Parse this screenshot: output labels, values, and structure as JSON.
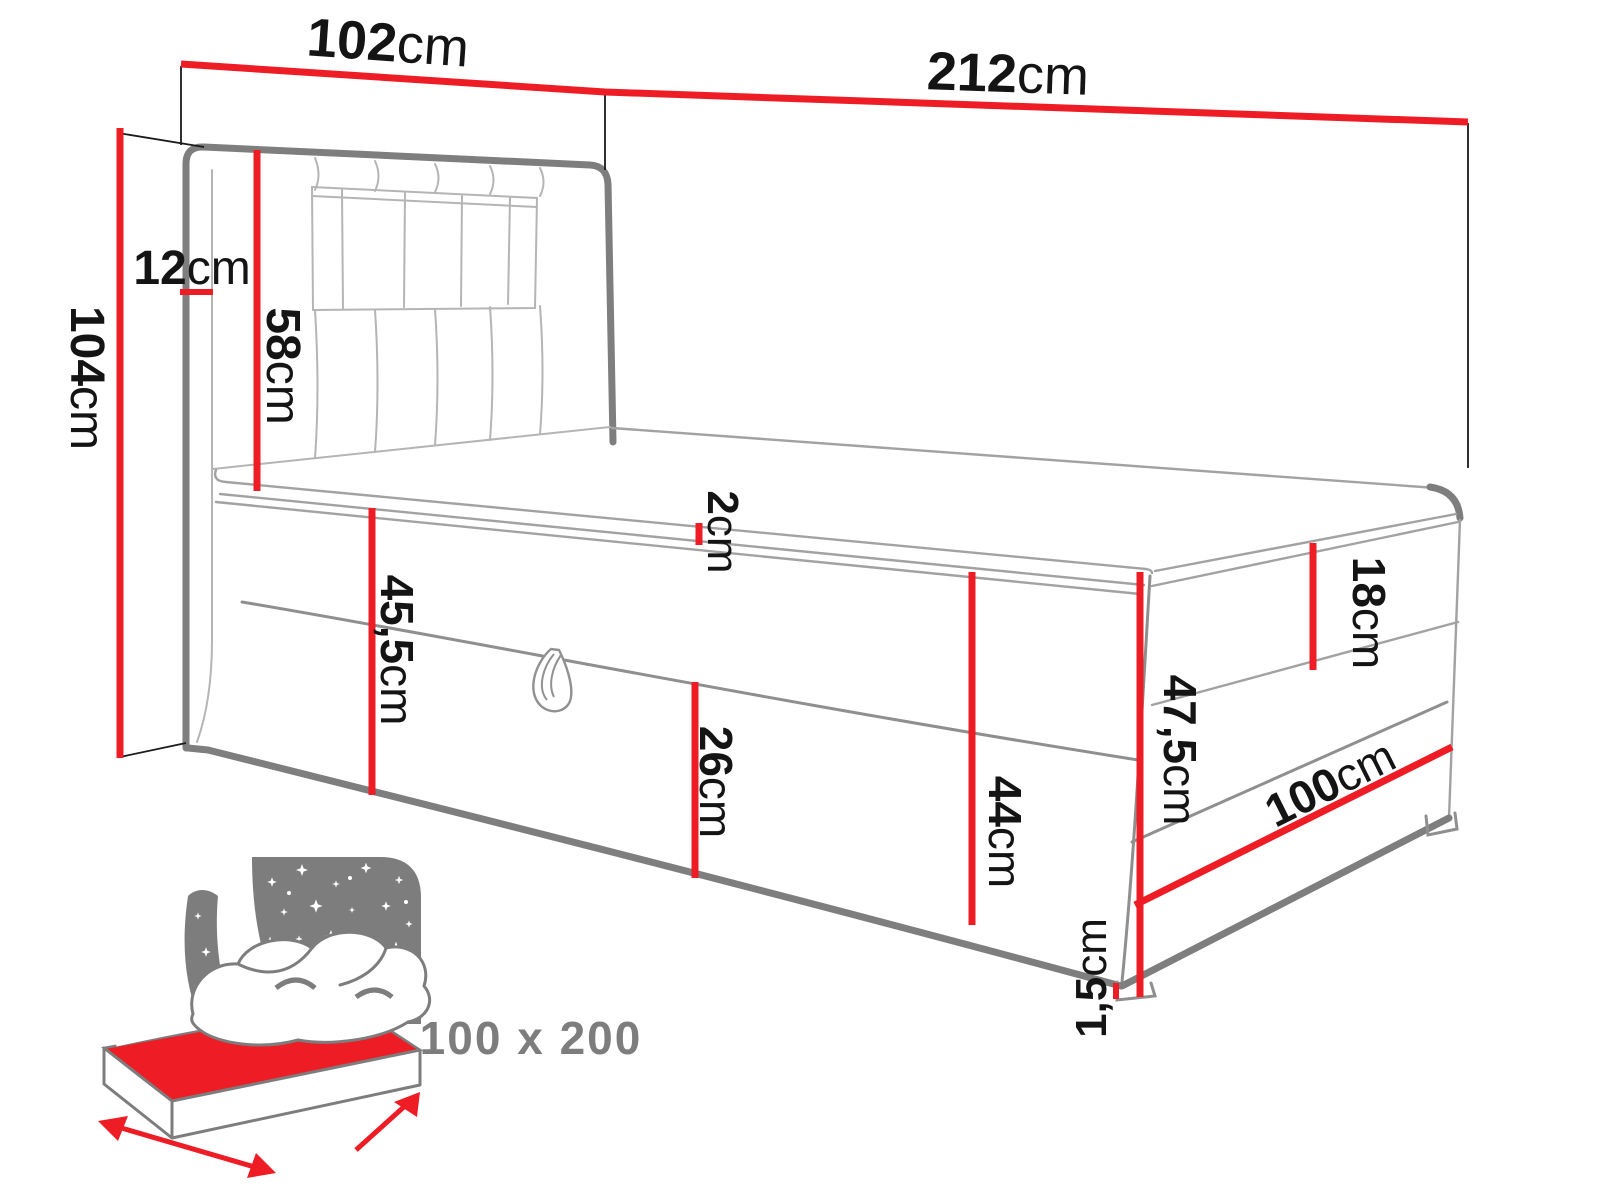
{
  "colors": {
    "accent": "#ee1c25",
    "outline": "#7e7e7e",
    "icon": "#7d7d7d",
    "label": "#141414"
  },
  "labels": {
    "headboard_width": {
      "num": "102",
      "unit": "cm"
    },
    "bed_total_length": {
      "num": "212",
      "unit": "cm"
    },
    "bed_total_height": {
      "num": "104",
      "unit": "cm"
    },
    "headboard_depth": {
      "num": "12",
      "unit": "cm"
    },
    "headboard_above_mattress": {
      "num": "58",
      "unit": "cm"
    },
    "topper_height": {
      "num": "2",
      "unit": "cm"
    },
    "side_box_height": {
      "num": "45,5",
      "unit": "cm"
    },
    "storage_flap_height": {
      "num": "26",
      "unit": "cm"
    },
    "base_height": {
      "num": "44",
      "unit": "cm"
    },
    "mattress_height": {
      "num": "18",
      "unit": "cm"
    },
    "foot_corner_height": {
      "num": "47,5",
      "unit": "cm"
    },
    "foot_width": {
      "num": "100",
      "unit": "cm"
    },
    "glide_height": {
      "num": "1,5",
      "unit": "cm"
    }
  },
  "icon_badge": {
    "text": "100 x 200"
  }
}
